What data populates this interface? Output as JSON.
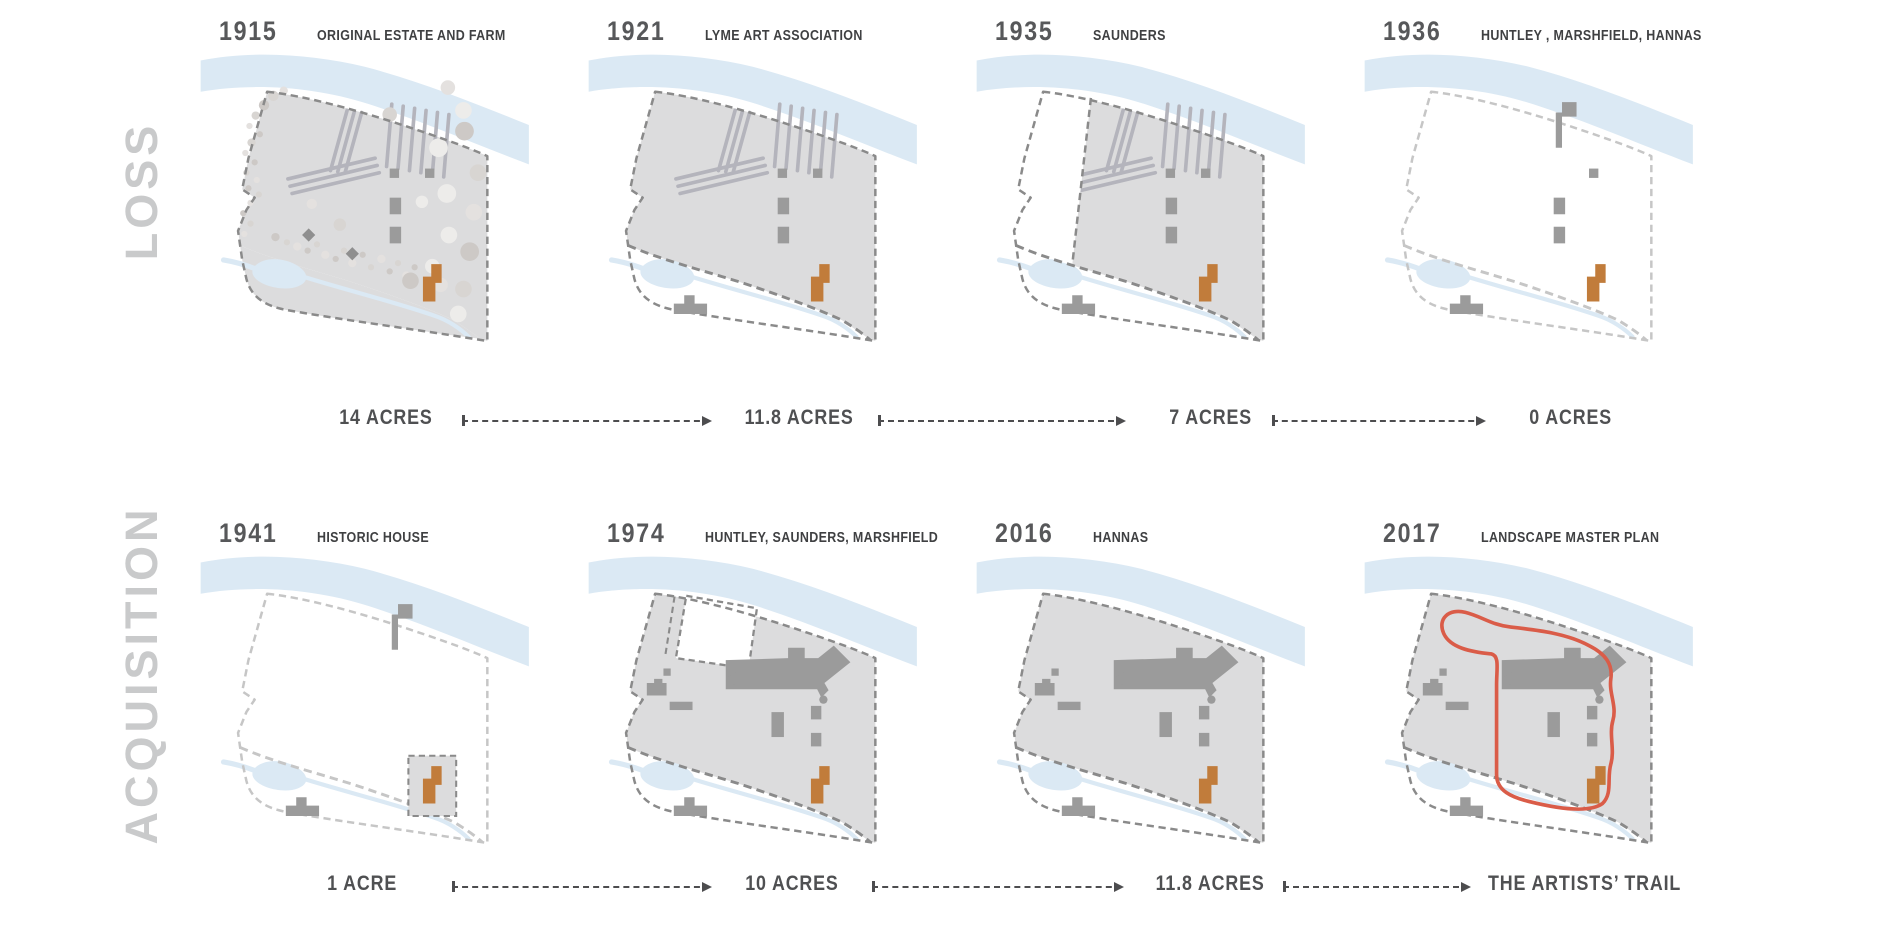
{
  "palette": {
    "land": "#dcdcdd",
    "water": "#dbe9f4",
    "building": "#9b9b9b",
    "building_dark": "#8f8f8f",
    "orange": "#c17c3b",
    "trail": "#da5c48",
    "dash_dark": "#8a8a8a",
    "dash_light": "#c6c6c6",
    "hatch": "#b4b4bc",
    "arrow": "#4d4d4f",
    "year_text": "#57585a",
    "title_text": "#3f4042",
    "acres_text": "#4f5052",
    "side_label_text": "#c9cacb"
  },
  "side_labels": {
    "top": "LOSS",
    "bottom": "ACQUISITION"
  },
  "acres_top": [
    "14 ACRES",
    "11.8 ACRES",
    "7 ACRES",
    "0 ACRES"
  ],
  "acres_bottom": [
    "1 ACRE",
    "10 ACRES",
    "11.8 ACRES",
    "THE ARTISTS’ TRAIL"
  ],
  "panels": [
    {
      "year": "1915",
      "title": "ORIGINAL ESTATE AND FARM",
      "features": {
        "north": "land",
        "south": "land",
        "trees": true,
        "hatch": true,
        "squares": "full",
        "orange": true,
        "caretaker": false,
        "stream_dash": null,
        "boundary": "dark",
        "flag": false,
        "campus": false,
        "west_lost": false,
        "notch": false,
        "acre_box": false,
        "trail": false
      }
    },
    {
      "year": "1921",
      "title": "LYME ART ASSOCIATION",
      "features": {
        "north": "land",
        "south": null,
        "trees": false,
        "hatch": true,
        "squares": "full",
        "orange": true,
        "caretaker": true,
        "stream_dash": "dark",
        "boundary": "dark",
        "flag": false,
        "campus": false,
        "west_lost": false,
        "notch": false,
        "acre_box": false,
        "trail": false
      }
    },
    {
      "year": "1935",
      "title": "SAUNDERS",
      "features": {
        "north": "land",
        "south": null,
        "trees": false,
        "hatch": true,
        "squares": "full",
        "orange": true,
        "caretaker": true,
        "stream_dash": "dark",
        "boundary": "dark",
        "flag": false,
        "campus": false,
        "west_lost": true,
        "notch": false,
        "acre_box": false,
        "trail": false
      }
    },
    {
      "year": "1936",
      "title": "HUNTLEY , MARSHFIELD, HANNAS",
      "features": {
        "north": null,
        "south": null,
        "trees": false,
        "hatch": false,
        "squares": "partial",
        "orange": true,
        "caretaker": true,
        "stream_dash": "light",
        "boundary": "light",
        "flag": true,
        "campus": false,
        "west_lost": false,
        "notch": false,
        "acre_box": false,
        "trail": false
      }
    },
    {
      "year": "1941",
      "title": "HISTORIC HOUSE",
      "features": {
        "north": null,
        "south": null,
        "trees": false,
        "hatch": false,
        "squares": false,
        "orange": true,
        "caretaker": true,
        "stream_dash": "light",
        "boundary": "light",
        "flag": true,
        "campus": false,
        "west_lost": false,
        "notch": false,
        "acre_box": true,
        "trail": false
      }
    },
    {
      "year": "1974",
      "title": "HUNTLEY, SAUNDERS, MARSHFIELD",
      "features": {
        "north": "land",
        "south": null,
        "trees": false,
        "hatch": false,
        "squares": false,
        "orange": true,
        "caretaker": true,
        "stream_dash": "dark",
        "boundary": "dark",
        "flag": false,
        "campus": true,
        "west_lost": false,
        "notch": true,
        "acre_box": false,
        "trail": false
      }
    },
    {
      "year": "2016",
      "title": "HANNAS",
      "features": {
        "north": "land",
        "south": null,
        "trees": false,
        "hatch": false,
        "squares": false,
        "orange": true,
        "caretaker": true,
        "stream_dash": "dark",
        "boundary": "dark",
        "flag": false,
        "campus": true,
        "west_lost": false,
        "notch": false,
        "acre_box": false,
        "trail": false
      }
    },
    {
      "year": "2017",
      "title": "LANDSCAPE MASTER PLAN",
      "features": {
        "north": "land",
        "south": null,
        "trees": false,
        "hatch": false,
        "squares": false,
        "orange": true,
        "caretaker": true,
        "stream_dash": "dark",
        "boundary": "dark",
        "flag": false,
        "campus": true,
        "west_lost": false,
        "notch": false,
        "acre_box": false,
        "trail": true
      }
    }
  ]
}
